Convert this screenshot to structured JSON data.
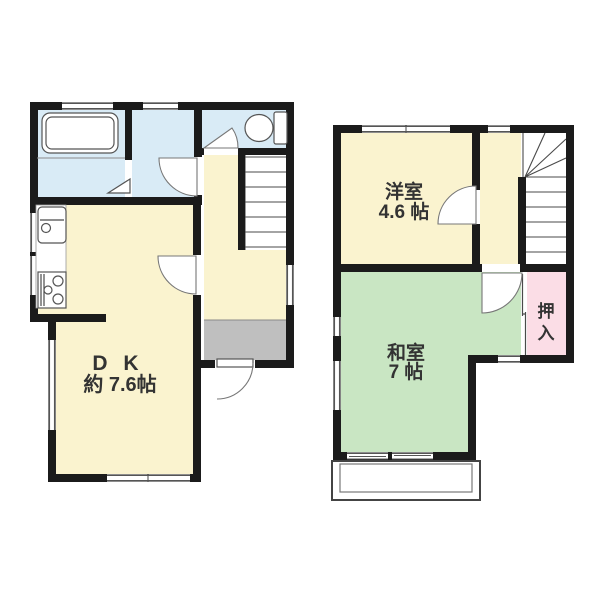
{
  "colors": {
    "wall": "#1b1b1b",
    "room_yellow": "#faf3cf",
    "wet_blue": "#d9ebf6",
    "tatami_green": "#c9e6c3",
    "closet_pink": "#fbdde6",
    "entry_gray": "#bfbfbf",
    "label_text": "#333333"
  },
  "floor1": {
    "dk": {
      "label": "D K",
      "size": "約 7.6帖"
    },
    "icons": [
      "bathtub-icon",
      "toilet-icon",
      "kitchen-sink-icon",
      "gas-stove-icon",
      "stairs-icon",
      "entry-door-icon"
    ]
  },
  "floor2": {
    "western_room": {
      "label": "洋室",
      "size": "4.6 帖"
    },
    "japanese_room": {
      "label": "和室",
      "size": "7 帖"
    },
    "closet": {
      "char1": "押",
      "char2": "入"
    },
    "icons": [
      "stairs-icon",
      "balcony-icon"
    ]
  }
}
